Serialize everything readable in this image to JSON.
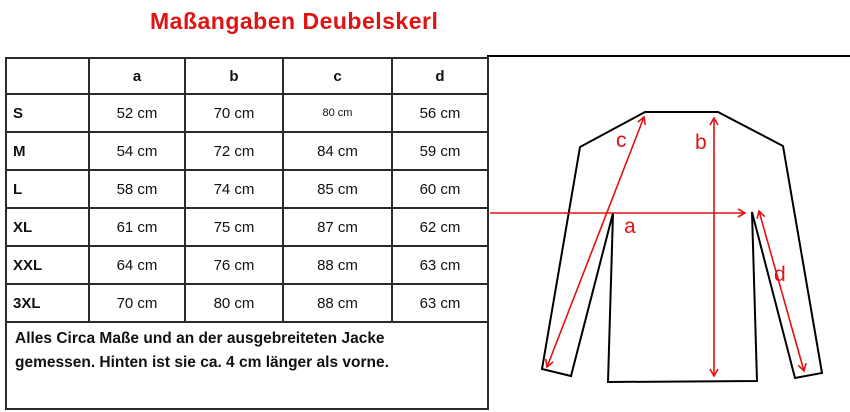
{
  "title": "Maßangaben Deubelskerl",
  "colors": {
    "accent_red": "#e01212",
    "line_black": "#000000"
  },
  "table": {
    "corner_label": "",
    "headers": [
      "a",
      "b",
      "c",
      "d"
    ],
    "rows": [
      {
        "size": "S",
        "a": "52 cm",
        "b": "70 cm",
        "c": "80 cm",
        "d": "56 cm"
      },
      {
        "size": "M",
        "a": "54 cm",
        "b": "72 cm",
        "c": "84 cm",
        "d": "59 cm"
      },
      {
        "size": "L",
        "a": "58 cm",
        "b": "74 cm",
        "c": "85 cm",
        "d": "60 cm"
      },
      {
        "size": "XL",
        "a": "61 cm",
        "b": "75 cm",
        "c": "87 cm",
        "d": "62 cm"
      },
      {
        "size": "XXL",
        "a": "64 cm",
        "b": "76 cm",
        "c": "88 cm",
        "d": "63 cm"
      },
      {
        "size": "3XL",
        "a": "70 cm",
        "b": "80 cm",
        "c": "88 cm",
        "d": "63 cm"
      }
    ],
    "note": "Alles Circa Maße und an der ausgebreiteten Jacke gemessen. Hinten ist sie ca. 4 cm länger als vorne."
  },
  "diagram": {
    "labels": {
      "a": "a",
      "b": "b",
      "c": "c",
      "d": "d"
    }
  }
}
